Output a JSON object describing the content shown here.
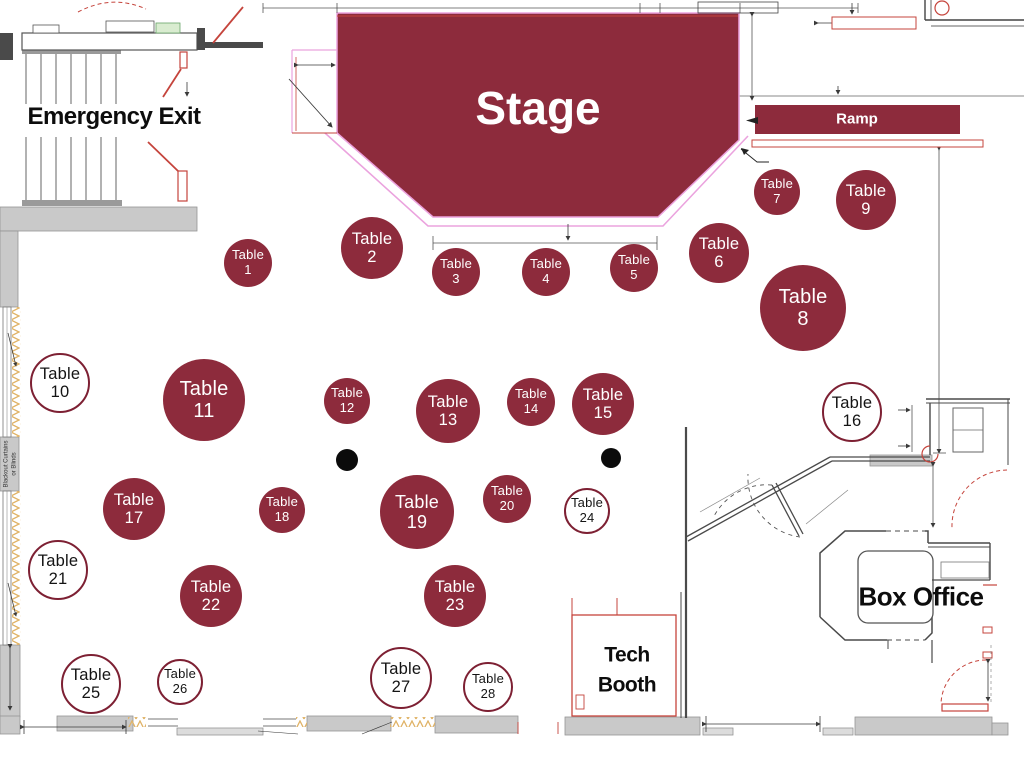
{
  "labels": {
    "table_word": "Table",
    "stage": "Stage",
    "ramp": "Ramp",
    "emergency_exit": "Emergency Exit",
    "box_office": "Box Office",
    "tech_booth_line1": "Tech",
    "tech_booth_line2": "Booth",
    "curtains_side_line1": "Blackout Curtains",
    "curtains_side_line2": "or Blinds"
  },
  "colors": {
    "maroon": "#8d2b3c",
    "maroon_dark": "#7d2033",
    "pink": "#eba3de",
    "green": "#3aae43",
    "red": "#c5443c",
    "ink": "#1a1a1a",
    "gray_wall": "#c9c9c9",
    "hatch": "#e0b367"
  },
  "tables": [
    {
      "n": "1",
      "x": 248,
      "y": 263,
      "r": 24,
      "style": "filled"
    },
    {
      "n": "2",
      "x": 372,
      "y": 248,
      "r": 31,
      "style": "filled"
    },
    {
      "n": "3",
      "x": 456,
      "y": 272,
      "r": 24,
      "style": "filled"
    },
    {
      "n": "4",
      "x": 546,
      "y": 272,
      "r": 24,
      "style": "filled"
    },
    {
      "n": "5",
      "x": 634,
      "y": 268,
      "r": 24,
      "style": "filled"
    },
    {
      "n": "6",
      "x": 719,
      "y": 253,
      "r": 30,
      "style": "filled"
    },
    {
      "n": "7",
      "x": 777,
      "y": 192,
      "r": 23,
      "style": "filled"
    },
    {
      "n": "8",
      "x": 803,
      "y": 308,
      "r": 43,
      "style": "filled"
    },
    {
      "n": "9",
      "x": 866,
      "y": 200,
      "r": 30,
      "style": "filled"
    },
    {
      "n": "10",
      "x": 60,
      "y": 383,
      "r": 30,
      "style": "outline"
    },
    {
      "n": "11",
      "x": 204,
      "y": 400,
      "r": 41,
      "style": "filled"
    },
    {
      "n": "12",
      "x": 347,
      "y": 401,
      "r": 23,
      "style": "filled"
    },
    {
      "n": "13",
      "x": 448,
      "y": 411,
      "r": 32,
      "style": "filled"
    },
    {
      "n": "14",
      "x": 531,
      "y": 402,
      "r": 24,
      "style": "filled"
    },
    {
      "n": "15",
      "x": 603,
      "y": 404,
      "r": 31,
      "style": "filled"
    },
    {
      "n": "16",
      "x": 852,
      "y": 412,
      "r": 30,
      "style": "outline"
    },
    {
      "n": "17",
      "x": 134,
      "y": 509,
      "r": 31,
      "style": "filled"
    },
    {
      "n": "18",
      "x": 282,
      "y": 510,
      "r": 23,
      "style": "filled"
    },
    {
      "n": "19",
      "x": 417,
      "y": 512,
      "r": 37,
      "style": "filled"
    },
    {
      "n": "20",
      "x": 507,
      "y": 499,
      "r": 24,
      "style": "filled"
    },
    {
      "n": "21",
      "x": 58,
      "y": 570,
      "r": 30,
      "style": "outline"
    },
    {
      "n": "22",
      "x": 211,
      "y": 596,
      "r": 31,
      "style": "filled"
    },
    {
      "n": "23",
      "x": 455,
      "y": 596,
      "r": 31,
      "style": "filled"
    },
    {
      "n": "24",
      "x": 587,
      "y": 511,
      "r": 23,
      "style": "outline"
    },
    {
      "n": "25",
      "x": 91,
      "y": 684,
      "r": 30,
      "style": "outline"
    },
    {
      "n": "26",
      "x": 180,
      "y": 682,
      "r": 23,
      "style": "outline"
    },
    {
      "n": "27",
      "x": 401,
      "y": 678,
      "r": 31,
      "style": "outline"
    },
    {
      "n": "28",
      "x": 488,
      "y": 687,
      "r": 25,
      "style": "outline"
    }
  ],
  "dots": [
    {
      "x": 347,
      "y": 460,
      "r": 11
    },
    {
      "x": 611,
      "y": 458,
      "r": 10
    }
  ],
  "annotations": [
    {
      "text": "+7",
      "x": 313,
      "y": 20,
      "rot": 0,
      "size": 9,
      "color": "green"
    },
    {
      "text": "+14",
      "x": 332,
      "y": 57,
      "rot": 90,
      "size": 9,
      "color": "green"
    },
    {
      "text": "+7",
      "x": 394,
      "y": 190,
      "rot": 41,
      "size": 9,
      "color": "green"
    },
    {
      "text": "+7",
      "x": 703,
      "y": 184,
      "rot": -41,
      "size": 9,
      "color": "green"
    },
    {
      "text": "+14",
      "x": 545,
      "y": 228,
      "rot": 180,
      "size": 8,
      "color": "green"
    },
    {
      "text": "Fix Me",
      "x": 390,
      "y": 9,
      "rot": 180,
      "size": 6,
      "color": "red"
    },
    {
      "text": "Pit to Dimmers",
      "x": 671,
      "y": 9,
      "rot": 180,
      "size": 6,
      "color": "red"
    },
    {
      "text": "Full Height Wall",
      "x": 309,
      "y": 112,
      "rot": 90,
      "size": 6,
      "color": "red"
    },
    {
      "text": "Existing Wall to Remain",
      "x": 738,
      "y": 8,
      "rot": 180,
      "size": 5.5,
      "color": "ink"
    },
    {
      "text": "Trough",
      "x": 130,
      "y": 27,
      "rot": 180,
      "size": 6.5,
      "color": "ink"
    },
    {
      "text": "Ladder",
      "x": 168,
      "y": 28,
      "rot": 180,
      "size": 6,
      "color": "ink"
    },
    {
      "text": "Haze Panel HPC",
      "x": 45,
      "y": 41,
      "rot": 180,
      "size": 5,
      "color": "ink"
    },
    {
      "text": "Wall Cabinet",
      "x": 965,
      "y": 570,
      "rot": 180,
      "size": 5.5,
      "color": "ink"
    },
    {
      "text": "Blackout Curtains",
      "x": 330,
      "y": 733,
      "rot": 180,
      "size": 6,
      "color": "ink"
    },
    {
      "text": "8'-6\"",
      "x": 316,
      "y": 60,
      "rot": 180,
      "size": 6.5,
      "color": "ink"
    },
    {
      "text": "15'-0\"",
      "x": 547,
      "y": 248,
      "rot": 180,
      "size": 6.5,
      "color": "ink"
    },
    {
      "text": "1'-0\"",
      "x": 780,
      "y": 163,
      "rot": 180,
      "size": 6.5,
      "color": "ink"
    },
    {
      "text": "6'-11\"",
      "x": 859,
      "y": 16,
      "rot": 180,
      "size": 6.5,
      "color": "ink"
    },
    {
      "text": "24'-8\"",
      "x": 941,
      "y": 290,
      "rot": -90,
      "size": 6.5,
      "color": "ink"
    },
    {
      "text": "3'-1\"",
      "x": 908,
      "y": 427,
      "rot": -90,
      "size": 6.5,
      "color": "ink"
    },
    {
      "text": "9'-3\"",
      "x": 937,
      "y": 496,
      "rot": -90,
      "size": 6.5,
      "color": "ink"
    },
    {
      "text": "8'-11\"",
      "x": 731,
      "y": 491,
      "rot": -34,
      "size": 6.5,
      "color": "ink"
    },
    {
      "text": "2'-3\"",
      "x": 827,
      "y": 502,
      "rot": -41,
      "size": 6.5,
      "color": "ink"
    },
    {
      "text": "5'-0\"",
      "x": 10,
      "y": 677,
      "rot": -90,
      "size": 8,
      "color": "ink"
    },
    {
      "text": "7'-5\"",
      "x": 75,
      "y": 727,
      "rot": 180,
      "size": 8,
      "color": "ink"
    },
    {
      "text": "2'-8\"",
      "x": 536,
      "y": 731,
      "rot": 180,
      "size": 8,
      "color": "ink"
    },
    {
      "text": "6'-0\"",
      "x": 776,
      "y": 723,
      "rot": 180,
      "size": 9,
      "color": "ink"
    },
    {
      "text": "3'-0\"",
      "x": 992,
      "y": 686,
      "rot": -90,
      "size": 6.5,
      "color": "ink"
    }
  ]
}
